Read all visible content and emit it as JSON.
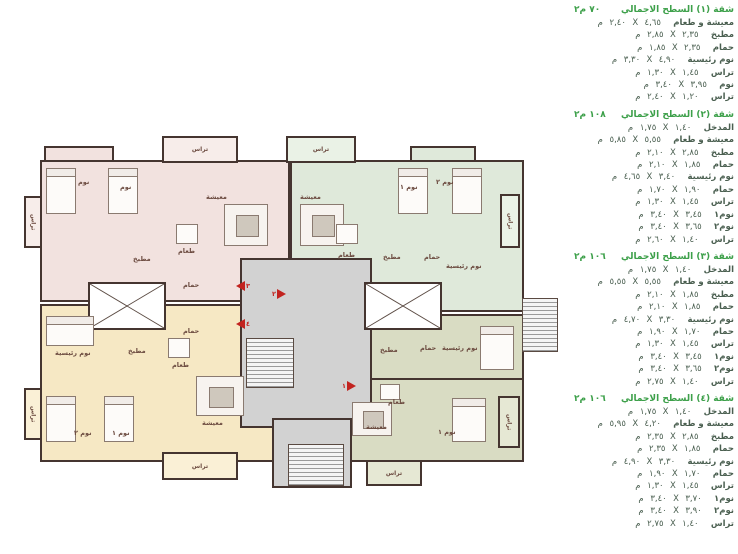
{
  "plan": {
    "colors": {
      "apartment_pink": "#f2e2df",
      "apartment_green": "#dfe9da",
      "apartment_cream": "#f6e8c4",
      "apartment_olive": "#d9dcc3",
      "core_gray": "#d2d2d2",
      "wall": "#453530",
      "marker_red": "#c2231f",
      "header_green": "#3da04a",
      "table_text": "#4a5f50"
    },
    "labels": {
      "living": "معيشة",
      "dining": "طعام",
      "kitchen": "مطبخ",
      "bath": "حمام",
      "bed": "نوم",
      "bed1": "نوم ١",
      "bed2": "نوم ٢",
      "master": "نوم رئيسية",
      "terrace": "تراس"
    },
    "markers": [
      "١",
      "٢",
      "٣",
      "٤"
    ]
  },
  "tables": {
    "unit": "م",
    "times": "X",
    "sections": [
      {
        "title": "شقة (١) السطح الاجمالي",
        "area": "٧٠ م٢",
        "rows": [
          {
            "label": "معيشة و طعام",
            "a": "٤,٦٥",
            "b": "٢,٤٠"
          },
          {
            "label": "مطبخ",
            "a": "٢,٣٥",
            "b": "٢,٨٥"
          },
          {
            "label": "حمام",
            "a": "٢,٣٥",
            "b": "١,٨٥"
          },
          {
            "label": "نوم رئيسية",
            "a": "٤,٩٠",
            "b": "٣,٣٠"
          },
          {
            "label": "تراس",
            "a": "١,٤٥",
            "b": "١,٣٠"
          },
          {
            "label": "نوم",
            "a": "٣,٩٥",
            "b": "٣,٤٠"
          },
          {
            "label": "تراس",
            "a": "١,٢٠",
            "b": "٢,٤٠"
          }
        ]
      },
      {
        "title": "شقة (٢) السطح الاجمالي",
        "area": "١٠٨ م٢",
        "rows": [
          {
            "label": "المدخل",
            "a": "١,٤٠",
            "b": "١,٧٥"
          },
          {
            "label": "معيشة و طعام",
            "a": "٥,٥٥",
            "b": "٥,٨٥"
          },
          {
            "label": "مطبخ",
            "a": "٢,٨٥",
            "b": "٢,١٠"
          },
          {
            "label": "حمام",
            "a": "١,٨٥",
            "b": "٢,١٠"
          },
          {
            "label": "نوم رئيسية",
            "a": "٣,٤٠",
            "b": "٤,٦٥"
          },
          {
            "label": "حمام",
            "a": "١,٩٠",
            "b": "١,٧٠"
          },
          {
            "label": "تراس",
            "a": "١,٤٥",
            "b": "١,٣٠"
          },
          {
            "label": "نوم١",
            "a": "٣,٤٥",
            "b": "٣,٤٠"
          },
          {
            "label": "نوم٢",
            "a": "٣,٦٥",
            "b": "٣,٤٠"
          },
          {
            "label": "تراس",
            "a": "١,٤٠",
            "b": "٢,٦٠"
          }
        ]
      },
      {
        "title": "شقة (٣) السطح الاجمالي",
        "area": "١٠٦ م٢",
        "rows": [
          {
            "label": "المدخل",
            "a": "١,٤٠",
            "b": "١,٧٥"
          },
          {
            "label": "معيشة و طعام",
            "a": "٥,٥٥",
            "b": "٥,٥٥"
          },
          {
            "label": "مطبخ",
            "a": "١,٨٥",
            "b": "٢,١٠"
          },
          {
            "label": "حمام",
            "a": "١,٨٥",
            "b": "٢,١٠"
          },
          {
            "label": "نوم رئيسية",
            "a": "٣,٣٠",
            "b": "٤,٧٠"
          },
          {
            "label": "حمام",
            "a": "١,٧٠",
            "b": "١,٩٠"
          },
          {
            "label": "تراس",
            "a": "١,٤٥",
            "b": "١,٣٠"
          },
          {
            "label": "نوم١",
            "a": "٣,٤٥",
            "b": "٣,٤٠"
          },
          {
            "label": "نوم٢",
            "a": "٣,٦٥",
            "b": "٣,٤٠"
          },
          {
            "label": "تراس",
            "a": "١,٤٠",
            "b": "٢,٧٥"
          }
        ]
      },
      {
        "title": "شقة (٤) السطح الاجمالي",
        "area": "١٠٦ م٢",
        "rows": [
          {
            "label": "المدخل",
            "a": "١,٤٠",
            "b": "١,٧٥"
          },
          {
            "label": "معيشة و طعام",
            "a": "٤,٢٠",
            "b": "٥,٩٥"
          },
          {
            "label": "مطبخ",
            "a": "٢,٨٥",
            "b": "٢,٣٥"
          },
          {
            "label": "حمام",
            "a": "١,٨٥",
            "b": "٢,٣٥"
          },
          {
            "label": "نوم رئيسية",
            "a": "٣,٣٠",
            "b": "٤,٩٠"
          },
          {
            "label": "حمام",
            "a": "١,٧٠",
            "b": "١,٩٠"
          },
          {
            "label": "تراس",
            "a": "١,٤٥",
            "b": "١,٣٠"
          },
          {
            "label": "نوم١",
            "a": "٣,٧٠",
            "b": "٣,٤٠"
          },
          {
            "label": "نوم٢",
            "a": "٣,٩٠",
            "b": "٣,٤٠"
          },
          {
            "label": "تراس",
            "a": "١,٤٠",
            "b": "٢,٧٥"
          }
        ]
      }
    ]
  }
}
